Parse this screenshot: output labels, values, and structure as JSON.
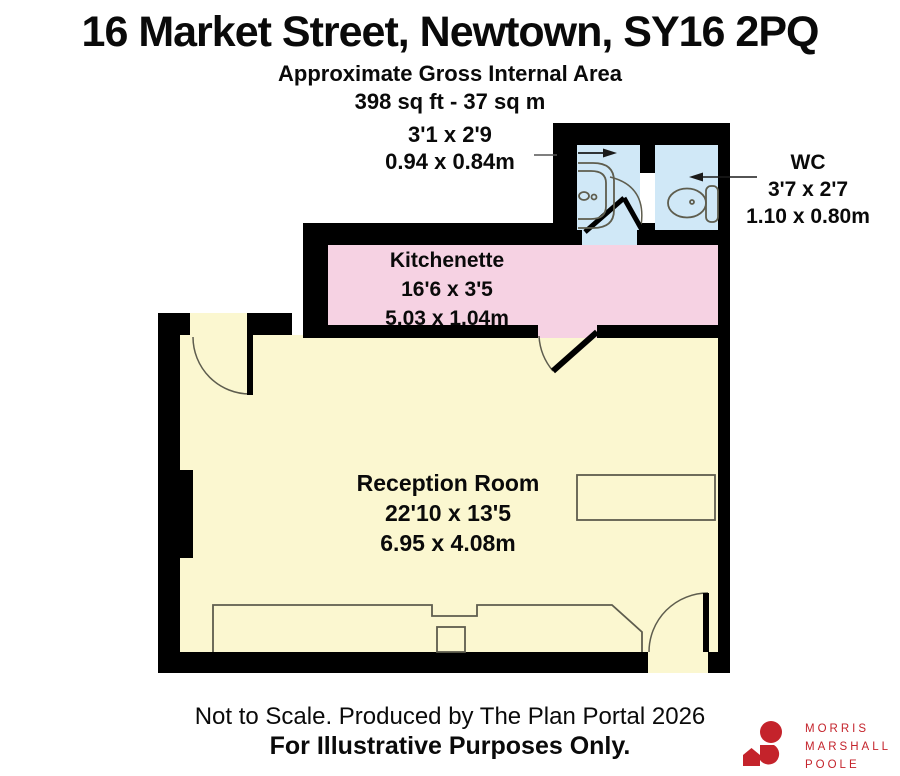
{
  "header": {
    "title": "16 Market Street, Newtown, SY16 2PQ",
    "subtitle1": "Approximate Gross Internal Area",
    "subtitle2": "398 sq ft - 37 sq m"
  },
  "rooms": {
    "wc_left": {
      "dims_ft": "3'1 x 2'9",
      "dims_m": "0.94 x 0.84m"
    },
    "wc_right": {
      "name": "WC",
      "dims_ft": "3'7 x 2'7",
      "dims_m": "1.10 x 0.80m"
    },
    "kitchenette": {
      "name": "Kitchenette",
      "dims_ft": "16'6 x 3'5",
      "dims_m": "5.03 x 1.04m"
    },
    "reception": {
      "name": "Reception Room",
      "dims_ft": "22'10 x 13'5",
      "dims_m": "6.95 x 4.08m"
    }
  },
  "footer": {
    "line1": "Not to Scale. Produced by The Plan Portal 2026",
    "line2": "For Illustrative Purposes Only."
  },
  "logo": {
    "line1": "MORRIS",
    "line2": "MARSHALL",
    "line3": "POOLE",
    "color": "#c4232b"
  },
  "colors": {
    "wall": "#000000",
    "room_yellow": "#fbf7d0",
    "room_pink": "#f6d2e3",
    "room_blue": "#d0e8f7",
    "furniture_line": "#5e5d4e",
    "arrow": "#1a1a1a"
  }
}
